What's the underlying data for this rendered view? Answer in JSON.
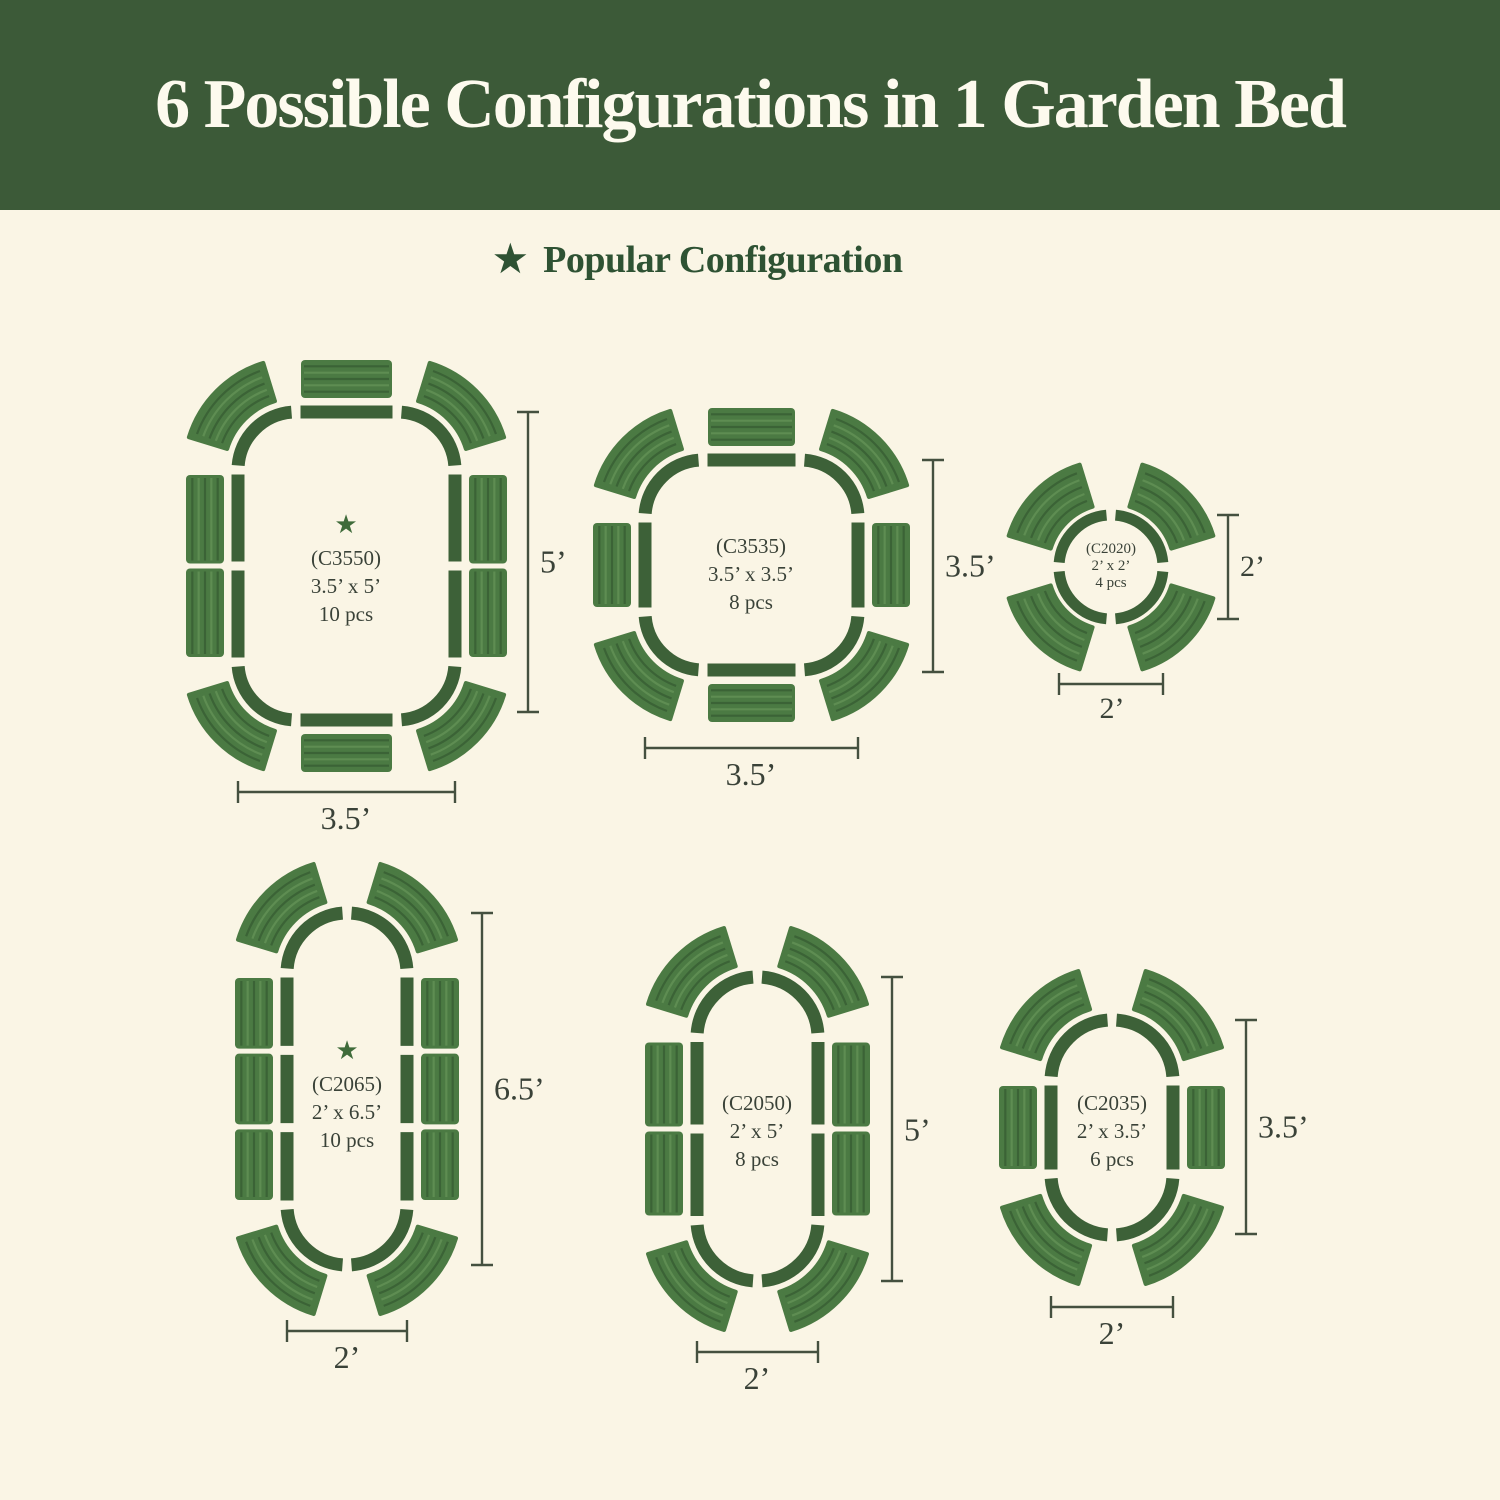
{
  "title": "6 Possible Configurations in 1 Garden Bed",
  "legend": {
    "star_icon": "★",
    "label": "Popular Configuration"
  },
  "colors": {
    "banner_background": "#3c5a38",
    "banner_text": "#fdfaee",
    "page_background": "#faf5e5",
    "legend_green": "#2e5233",
    "outline_green": "#3d6138",
    "panel_green": "#4b7a43",
    "panel_stripe_dark": "#3b6336",
    "panel_stripe_light": "#5e8d52",
    "label_text": "#3a4238",
    "dimension_line": "#44503f",
    "star_green": "#3f6b3a"
  },
  "configs": [
    {
      "code": "(C3550)",
      "size": "3.5’ x 5’",
      "pieces": "10 pcs",
      "popular": true,
      "popular_star": "★",
      "width_label": "3.5’",
      "height_label": "5’"
    },
    {
      "code": "(C3535)",
      "size": "3.5’ x 3.5’",
      "pieces": "8 pcs",
      "popular": false,
      "width_label": "3.5’",
      "height_label": "3.5’"
    },
    {
      "code": "(C2020)",
      "size": "2’ x 2’",
      "pieces": "4 pcs",
      "popular": false,
      "width_label": "2’",
      "height_label": "2’"
    },
    {
      "code": "(C2065)",
      "size": "2’ x 6.5’",
      "pieces": "10 pcs",
      "popular": true,
      "popular_star": "★",
      "width_label": "2’",
      "height_label": "6.5’"
    },
    {
      "code": "(C2050)",
      "size": "2’ x 5’",
      "pieces": "8 pcs",
      "popular": false,
      "width_label": "2’",
      "height_label": "5’"
    },
    {
      "code": "(C2035)",
      "size": "2’ x 3.5’",
      "pieces": "6 pcs",
      "popular": false,
      "width_label": "2’",
      "height_label": "3.5’"
    }
  ]
}
